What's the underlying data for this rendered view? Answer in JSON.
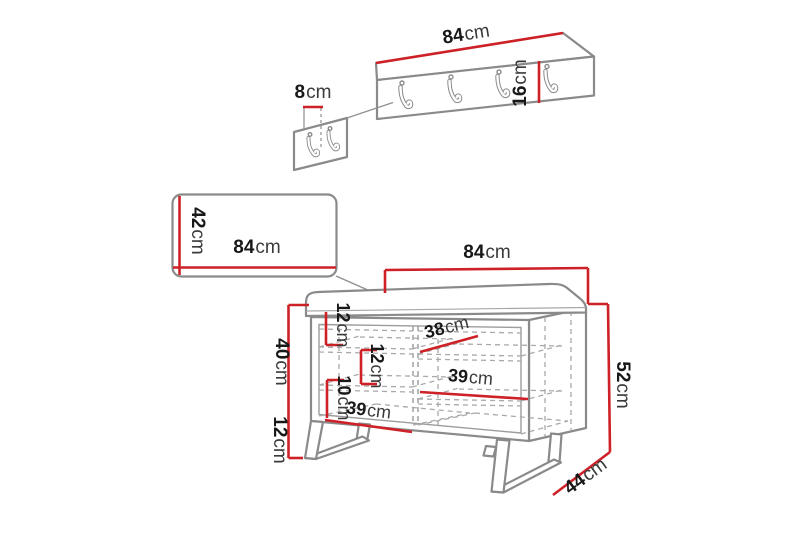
{
  "diagram": {
    "kind": "furniture dimension diagram (hallway set: hook rail, wall panel, storage bench)",
    "unit": "cm",
    "colors": {
      "dimension_red": "#ce2127",
      "outline_gray": "#8a8a8a",
      "text_dark": "#181818",
      "background": "#ffffff"
    }
  },
  "labels": {
    "rail_width": {
      "value": "84",
      "unit": "cm"
    },
    "rail_height": {
      "value": "16",
      "unit": "cm"
    },
    "hook_spacing": {
      "value": "8",
      "unit": "cm"
    },
    "panel_height": {
      "value": "42",
      "unit": "cm"
    },
    "panel_width": {
      "value": "84",
      "unit": "cm"
    },
    "bench_width": {
      "value": "84",
      "unit": "cm"
    },
    "bench_height": {
      "value": "52",
      "unit": "cm"
    },
    "bench_depth": {
      "value": "44",
      "unit": "cm"
    },
    "bench_body_height": {
      "value": "40",
      "unit": "cm"
    },
    "bench_leg_height": {
      "value": "12",
      "unit": "cm"
    },
    "shelf_top_gap": {
      "value": "12",
      "unit": "cm"
    },
    "shelf_right_top": {
      "value": "38",
      "unit": "cm"
    },
    "shelf_mid_gap": {
      "value": "12",
      "unit": "cm"
    },
    "shelf_lower_gap": {
      "value": "10",
      "unit": "cm"
    },
    "shelf_right_mid": {
      "value": "39",
      "unit": "cm"
    },
    "shelf_left_bottom": {
      "value": "39",
      "unit": "cm"
    }
  },
  "counts": {
    "rail_hooks": 4,
    "single_panel_hooks": 2
  }
}
